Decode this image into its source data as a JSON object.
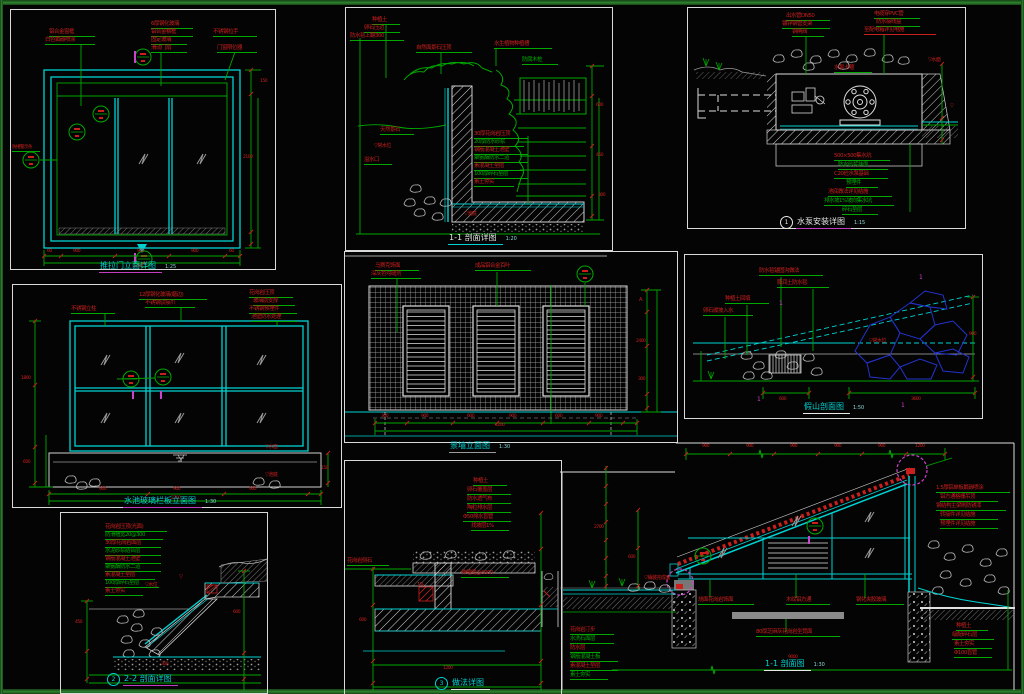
{
  "sheet": {
    "background": "#040404",
    "frame_color": "#2e8430",
    "drawing_type": "CAD detail sheet"
  },
  "colors": {
    "red": "#c9201e",
    "green": "#00a800",
    "cyan": "#00d2d2",
    "magenta": "#cc44cc",
    "white": "#e2e2e2",
    "gray": "#9a9a9a",
    "blue": "#2233cc"
  },
  "panels": [
    {
      "id": "p1",
      "name": "sliding-door-elevation-detail",
      "title": {
        "text": "推拉门立面详图",
        "x": 88,
        "y": 250,
        "color": "#00d2d2",
        "underline": "#c23cc2",
        "scale": "1:25"
      }
    },
    {
      "id": "p2",
      "name": "pond-wall-section-1-1",
      "title": {
        "text": "1-1 剖面详图",
        "x": 102,
        "y": 224,
        "color": "#e8e8e8",
        "underline": "#00d2d2",
        "scale": "1:20"
      }
    },
    {
      "id": "p3",
      "name": "pump-installation-detail",
      "title": {
        "text": "水泵安装详图",
        "x": 92,
        "y": 208,
        "color": "#e8e8e8",
        "underline": "#c23cc2",
        "bubble": "1",
        "scale": "1:15"
      }
    },
    {
      "id": "p4",
      "name": "pool-glass-screen-elevation",
      "title": {
        "text": "水池玻璃栏板立面图",
        "x": 110,
        "y": 210,
        "color": "#00d2d2",
        "underline": "#c23cc2",
        "scale": "1:30"
      }
    },
    {
      "id": "p5",
      "name": "feature-wall-elevation",
      "title": {
        "text": "景墙立面图",
        "x": 104,
        "y": 188,
        "color": "#00d2d2",
        "underline": "#9a9a9a",
        "scale": "1:30"
      }
    },
    {
      "id": "p6",
      "name": "rockery-section",
      "title": {
        "text": "假山剖面图",
        "x": 118,
        "y": 146,
        "color": "#00d2d2",
        "underline": "#e8e8e8",
        "scale": "1:50"
      }
    },
    {
      "id": "p7",
      "name": "pool-edge-section-2-2",
      "title": {
        "text": "2-2 剖面详图",
        "x": 46,
        "y": 160,
        "color": "#00d2d2",
        "underline": "#c23cc2",
        "bubble": "2"
      }
    },
    {
      "id": "p8",
      "name": "planter-edge-detail",
      "title": {
        "text": "做法详图",
        "x": 90,
        "y": 216,
        "color": "#00d2d2",
        "underline": "#e8e8e8",
        "bubble": "3"
      }
    },
    {
      "id": "p9",
      "name": "pergola-wall-section-1-1",
      "title": {
        "text": "1-1 剖面图",
        "x": 204,
        "y": 218,
        "color": "#00d2d2",
        "underline": "#e8e8e8",
        "scale": "1:30"
      }
    }
  ],
  "annotations": {
    "p1": [
      {
        "t": "铝合金窗框",
        "x": 38,
        "y": 20,
        "u": 46
      },
      {
        "t": "白色氟碳喷涂",
        "x": 34,
        "y": 28,
        "u": 50
      },
      {
        "t": "6厚钢化玻璃",
        "x": 140,
        "y": 12,
        "u": 42
      },
      {
        "t": "铝合金横框",
        "x": 140,
        "y": 20,
        "u": 42
      },
      {
        "t": "固定玻璃",
        "x": 140,
        "y": 28,
        "u": 36
      },
      {
        "t": "滑动门扇",
        "x": 140,
        "y": 36,
        "u": 36
      },
      {
        "t": "不锈钢拉手",
        "x": 202,
        "y": 20,
        "u": 44
      },
      {
        "t": "门窗限位器",
        "x": 206,
        "y": 36,
        "u": 40
      },
      {
        "t": "防撞警示条",
        "x": 1,
        "y": 136,
        "u": 28,
        "fs": 4.5
      },
      {
        "t": "60",
        "x": 36,
        "y": 240,
        "fs": 4.5
      },
      {
        "t": "900",
        "x": 62,
        "y": 240,
        "fs": 4.5
      },
      {
        "t": "900",
        "x": 126,
        "y": 240,
        "fs": 4.5
      },
      {
        "t": "900",
        "x": 180,
        "y": 240,
        "fs": 4.5
      },
      {
        "t": "60",
        "x": 218,
        "y": 240,
        "fs": 4.5
      },
      {
        "t": "2400",
        "x": 122,
        "y": 255,
        "fs": 4.5
      },
      {
        "t": "2100",
        "x": 232,
        "y": 146,
        "fs": 4.5
      },
      {
        "t": "150",
        "x": 249,
        "y": 70,
        "fs": 4.5
      }
    ],
    "p2": [
      {
        "t": "种植土",
        "x": 26,
        "y": 10,
        "u": 28
      },
      {
        "t": "卵石压边",
        "x": 18,
        "y": 18,
        "u": 36
      },
      {
        "t": "防水毯上翻300",
        "x": 4,
        "y": 26,
        "u": 54
      },
      {
        "t": "自然面景石压顶",
        "x": 70,
        "y": 38,
        "u": 56
      },
      {
        "t": "水生植物种植槽",
        "x": 148,
        "y": 34,
        "u": 58
      },
      {
        "t": "防腐木桩",
        "x": 176,
        "y": 50,
        "u": 36,
        "c": "green"
      },
      {
        "t": "30厚花岗岩压顶",
        "x": 128,
        "y": 124,
        "u": 54
      },
      {
        "t": "20厚防水砂浆",
        "x": 128,
        "y": 132,
        "u": 50,
        "c": "green"
      },
      {
        "t": "钢筋混凝土池壁",
        "x": 128,
        "y": 140,
        "u": 54
      },
      {
        "t": "聚氨酯防水二道",
        "x": 128,
        "y": 148,
        "u": 54,
        "c": "green"
      },
      {
        "t": "素混凝土垫层",
        "x": 128,
        "y": 156,
        "u": 50
      },
      {
        "t": "100厚碎石垫层",
        "x": 128,
        "y": 164,
        "u": 54,
        "c": "green"
      },
      {
        "t": "素土夯实",
        "x": 128,
        "y": 172,
        "u": 40
      },
      {
        "t": "天然景石",
        "x": 34,
        "y": 120,
        "u": 34
      },
      {
        "t": "▽常水位",
        "x": 28,
        "y": 136,
        "fs": 5
      },
      {
        "t": "溢水口",
        "x": 18,
        "y": 150,
        "u": 28
      },
      {
        "t": "600",
        "x": 250,
        "y": 96,
        "fs": 4.5
      },
      {
        "t": "450",
        "x": 250,
        "y": 146,
        "fs": 4.5
      },
      {
        "t": "300",
        "x": 252,
        "y": 186,
        "fs": 4.5
      },
      {
        "t": "▽池底",
        "x": 118,
        "y": 204,
        "fs": 5
      }
    ],
    "p3": [
      {
        "t": "出水管DN50",
        "x": 98,
        "y": 6,
        "u": 44
      },
      {
        "t": "镀锌钢管支架",
        "x": 94,
        "y": 14,
        "u": 48
      },
      {
        "t": "铜闸阀",
        "x": 104,
        "y": 22,
        "u": 32
      },
      {
        "t": "电缆穿PVC管",
        "x": 186,
        "y": 4,
        "u": 46
      },
      {
        "t": "防水接线盒",
        "x": 188,
        "y": 12,
        "u": 44
      },
      {
        "t": "至配电箱详见电施",
        "x": 176,
        "y": 20,
        "u": 72,
        "uc": "red"
      },
      {
        "t": "水泵卡箍",
        "x": 146,
        "y": 58,
        "u": 38
      },
      {
        "t": "▽水面",
        "x": 240,
        "y": 50,
        "fs": 5
      },
      {
        "t": "▽",
        "x": 262,
        "y": 96,
        "fs": 5
      },
      {
        "t": "500×500集水坑",
        "x": 146,
        "y": 146,
        "u": 56
      },
      {
        "t": "防水砂浆抹面",
        "x": 150,
        "y": 155,
        "u": 50,
        "c": "green"
      },
      {
        "t": "C20砼水泵基础",
        "x": 146,
        "y": 164,
        "u": 54
      },
      {
        "t": "预埋件",
        "x": 158,
        "y": 173,
        "u": 32,
        "c": "green"
      },
      {
        "t": "池底做法详见结施",
        "x": 140,
        "y": 182,
        "u": 64
      },
      {
        "t": "排水坡1%坡向集水坑",
        "x": 136,
        "y": 191,
        "u": 70,
        "c": "green"
      },
      {
        "t": "碎石垫层",
        "x": 154,
        "y": 200,
        "u": 36,
        "c": "green"
      }
    ],
    "p4": [
      {
        "t": "不锈钢立柱",
        "x": 58,
        "y": 22,
        "u": 44
      },
      {
        "t": "12厚钢化玻璃(磨边)",
        "x": 126,
        "y": 8,
        "u": 68
      },
      {
        "t": "不锈钢驳接爪",
        "x": 132,
        "y": 16,
        "u": 50
      },
      {
        "t": "花岗岩压顶",
        "x": 236,
        "y": 6,
        "u": 44
      },
      {
        "t": "玻璃肋支撑",
        "x": 240,
        "y": 14,
        "u": 42
      },
      {
        "t": "不锈钢预埋件",
        "x": 236,
        "y": 22,
        "u": 48
      },
      {
        "t": "池壁防水处理",
        "x": 238,
        "y": 30,
        "u": 46
      },
      {
        "t": "▽水面",
        "x": 252,
        "y": 160,
        "fs": 5
      },
      {
        "t": "▽池底",
        "x": 252,
        "y": 188,
        "fs": 5
      },
      {
        "t": "1800",
        "x": 8,
        "y": 92,
        "fs": 4.5
      },
      {
        "t": "600",
        "x": 10,
        "y": 176,
        "fs": 4.5
      },
      {
        "t": "900",
        "x": 86,
        "y": 203,
        "fs": 4.5
      },
      {
        "t": "900",
        "x": 160,
        "y": 203,
        "fs": 4.5
      },
      {
        "t": "900",
        "x": 236,
        "y": 203,
        "fs": 4.5
      },
      {
        "t": "2700",
        "x": 158,
        "y": 212,
        "fs": 4.5
      },
      {
        "t": "150",
        "x": 308,
        "y": 182,
        "fs": 4.5
      }
    ],
    "p5": [
      {
        "t": "马赛克饰面",
        "x": 30,
        "y": 12,
        "u": 44
      },
      {
        "t": "深灰色勾缝剂",
        "x": 26,
        "y": 20,
        "u": 50
      },
      {
        "t": "成品铝合金百叶",
        "x": 130,
        "y": 12,
        "u": 56
      },
      {
        "t": "A",
        "x": 294,
        "y": 46,
        "fs": 5
      },
      {
        "t": "2400",
        "x": 291,
        "y": 88,
        "fs": 4.5
      },
      {
        "t": "300",
        "x": 293,
        "y": 126,
        "fs": 4.5
      },
      {
        "t": "300",
        "x": 36,
        "y": 163,
        "fs": 4.5
      },
      {
        "t": "900",
        "x": 76,
        "y": 163,
        "fs": 4.5
      },
      {
        "t": "600",
        "x": 122,
        "y": 163,
        "fs": 4.5
      },
      {
        "t": "900",
        "x": 164,
        "y": 163,
        "fs": 4.5
      },
      {
        "t": "600",
        "x": 210,
        "y": 163,
        "fs": 4.5
      },
      {
        "t": "900",
        "x": 250,
        "y": 163,
        "fs": 4.5
      },
      {
        "t": "4200",
        "x": 150,
        "y": 172,
        "fs": 4.5
      }
    ],
    "p6": [
      {
        "t": "防水毯锚固沟做法",
        "x": 74,
        "y": 14,
        "u": 64
      },
      {
        "t": "膨润土防水毯",
        "x": 92,
        "y": 26,
        "u": 52
      },
      {
        "t": "种植土回填",
        "x": 40,
        "y": 42,
        "u": 44
      },
      {
        "t": "卵石缓坡入水",
        "x": 18,
        "y": 54,
        "u": 50
      },
      {
        "t": "▽常水位",
        "x": 184,
        "y": 84,
        "fs": 5
      },
      {
        "t": "1",
        "x": 94,
        "y": 46,
        "c": "magenta",
        "fs": 6
      },
      {
        "t": "1",
        "x": 234,
        "y": 20,
        "c": "magenta",
        "fs": 6
      },
      {
        "t": "1",
        "x": 72,
        "y": 142,
        "c": "magenta",
        "fs": 6
      },
      {
        "t": "1",
        "x": 216,
        "y": 148,
        "c": "magenta",
        "fs": 6
      },
      {
        "t": "600",
        "x": 94,
        "y": 143,
        "fs": 4.5
      },
      {
        "t": "3600",
        "x": 226,
        "y": 143,
        "fs": 4.5
      },
      {
        "t": "900",
        "x": 284,
        "y": 78,
        "fs": 4.5
      }
    ],
    "p7": [
      {
        "t": "花岗岩压顶(光面)",
        "x": 44,
        "y": 12,
        "u": 62
      },
      {
        "t": "防滑槽宽20@300",
        "x": 44,
        "y": 20,
        "u": 58,
        "c": "green"
      },
      {
        "t": "30厚花岗岩面层",
        "x": 44,
        "y": 28,
        "u": 56
      },
      {
        "t": "水泥砂浆结合层",
        "x": 44,
        "y": 36,
        "u": 56,
        "c": "green"
      },
      {
        "t": "钢筋混凝土池壁",
        "x": 44,
        "y": 44,
        "u": 56
      },
      {
        "t": "聚氨酯防水二道",
        "x": 44,
        "y": 52,
        "u": 56,
        "c": "green"
      },
      {
        "t": "素混凝土垫层",
        "x": 44,
        "y": 60,
        "u": 50
      },
      {
        "t": "100厚碎石垫层",
        "x": 44,
        "y": 68,
        "u": 54,
        "c": "green"
      },
      {
        "t": "素土夯实",
        "x": 44,
        "y": 76,
        "u": 38
      },
      {
        "t": "▽水位",
        "x": 84,
        "y": 70,
        "fs": 5
      },
      {
        "t": "▽",
        "x": 118,
        "y": 62,
        "fs": 5
      },
      {
        "t": "450",
        "x": 14,
        "y": 108,
        "fs": 4.5
      },
      {
        "t": "600",
        "x": 172,
        "y": 98,
        "fs": 4.5
      },
      {
        "t": "300",
        "x": 100,
        "y": 150,
        "fs": 4.5
      }
    ],
    "p8": [
      {
        "t": "种植土",
        "x": 128,
        "y": 18,
        "u": 34
      },
      {
        "t": "卵石覆盖层",
        "x": 122,
        "y": 27,
        "u": 44
      },
      {
        "t": "防水透气布",
        "x": 122,
        "y": 36,
        "u": 44
      },
      {
        "t": "陶粒排水层",
        "x": 122,
        "y": 45,
        "u": 44
      },
      {
        "t": "Φ50排水盲管",
        "x": 118,
        "y": 54,
        "u": 48
      },
      {
        "t": "找坡层1%",
        "x": 126,
        "y": 63,
        "u": 38
      },
      {
        "t": "花岗岩侧石",
        "x": 2,
        "y": 98,
        "u": 42
      },
      {
        "t": "伸缩缝@6000",
        "x": 116,
        "y": 110,
        "u": 48
      },
      {
        "t": "1%",
        "x": 72,
        "y": 122,
        "fs": 5
      },
      {
        "t": "600",
        "x": 14,
        "y": 158,
        "fs": 4.5
      },
      {
        "t": "1200",
        "x": 98,
        "y": 206,
        "fs": 4.5
      }
    ],
    "p9": [
      {
        "t": "900",
        "x": 142,
        "y": 5,
        "fs": 4.5
      },
      {
        "t": "900",
        "x": 186,
        "y": 5,
        "fs": 4.5
      },
      {
        "t": "900",
        "x": 230,
        "y": 5,
        "fs": 4.5
      },
      {
        "t": "900",
        "x": 274,
        "y": 5,
        "fs": 4.5
      },
      {
        "t": "900",
        "x": 318,
        "y": 5,
        "fs": 4.5
      },
      {
        "t": "1200",
        "x": 355,
        "y": 5,
        "fs": 4.5
      },
      {
        "t": "1.5厚铝单板氟碳喷涂",
        "x": 376,
        "y": 46,
        "u": 74
      },
      {
        "t": "铝方通格栅吊顶",
        "x": 380,
        "y": 55,
        "u": 58
      },
      {
        "t": "钢结构主梁刷防锈漆",
        "x": 376,
        "y": 64,
        "u": 70
      },
      {
        "t": "转接件详见结施",
        "x": 380,
        "y": 73,
        "u": 58
      },
      {
        "t": "预埋件详见结施",
        "x": 380,
        "y": 82,
        "u": 58
      },
      {
        "t": "烧面花岗岩饰面",
        "x": 138,
        "y": 158,
        "u": 56
      },
      {
        "t": "木纹铝方通",
        "x": 226,
        "y": 158,
        "u": 44
      },
      {
        "t": "钢化夹胶玻璃",
        "x": 296,
        "y": 158,
        "u": 48
      },
      {
        "t": "80厚芝麻灰花岗岩坐凳面",
        "x": 196,
        "y": 190,
        "u": 84
      },
      {
        "t": "种植土",
        "x": 396,
        "y": 184,
        "u": 32
      },
      {
        "t": "级配碎石层",
        "x": 392,
        "y": 193,
        "u": 42
      },
      {
        "t": "素土夯实",
        "x": 394,
        "y": 202,
        "u": 38
      },
      {
        "t": "Φ100盲管",
        "x": 394,
        "y": 211,
        "u": 38
      },
      {
        "t": "花岗岩汀步",
        "x": 10,
        "y": 188,
        "u": 44
      },
      {
        "t": "水洗石面层",
        "x": 10,
        "y": 197,
        "u": 44,
        "c": "green"
      },
      {
        "t": "防水层",
        "x": 10,
        "y": 206,
        "u": 30
      },
      {
        "t": "钢筋混凝土板",
        "x": 10,
        "y": 215,
        "u": 48,
        "c": "green"
      },
      {
        "t": "素混凝土垫层",
        "x": 10,
        "y": 224,
        "u": 48
      },
      {
        "t": "素土夯实",
        "x": 10,
        "y": 233,
        "u": 38,
        "c": "green"
      },
      {
        "t": "2700",
        "x": 34,
        "y": 86,
        "fs": 4.5
      },
      {
        "t": "600",
        "x": 68,
        "y": 116,
        "fs": 4.5
      },
      {
        "t": "▽铺装完成面",
        "x": 84,
        "y": 136,
        "fs": 5
      },
      {
        "t": "9000",
        "x": 228,
        "y": 216,
        "fs": 4.5
      }
    ]
  }
}
